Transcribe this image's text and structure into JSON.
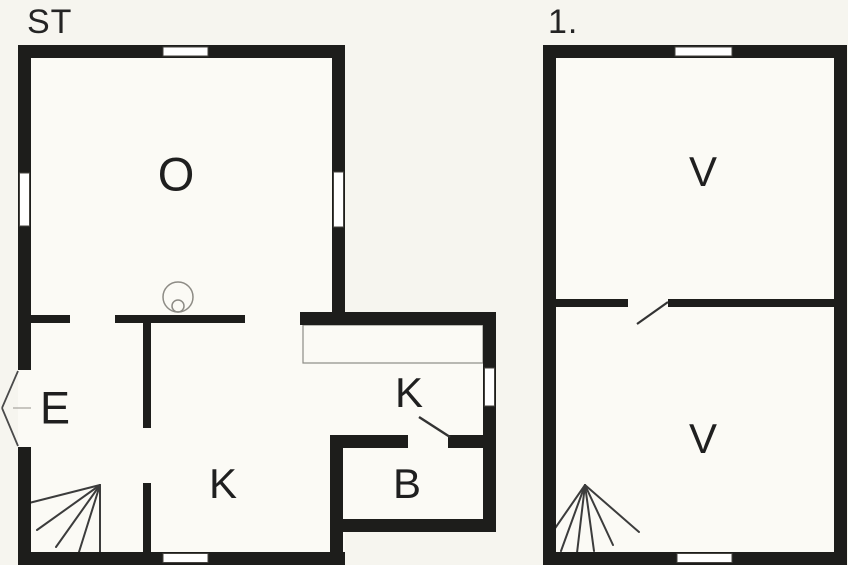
{
  "colors": {
    "wall": "#1d1d1b",
    "background": "#f6f5ef",
    "floor": "#fbfaf5",
    "window": "#ffffff",
    "stair_line": "#3c3c3c",
    "door_line": "#333333",
    "fixture_outline": "#8d8b85"
  },
  "floors": [
    {
      "title": "ST",
      "rooms": [
        {
          "label": "O"
        },
        {
          "label": "E"
        },
        {
          "label": "K"
        },
        {
          "label": "K"
        },
        {
          "label": "B"
        }
      ],
      "symbols": [
        "entrance-door-icon",
        "stove-icon",
        "stairs-icon",
        "door-swing-icon",
        "kitchen-counter",
        "window"
      ]
    },
    {
      "title": "1.",
      "rooms": [
        {
          "label": "V"
        },
        {
          "label": "V"
        }
      ],
      "symbols": [
        "stairs-icon",
        "door-swing-icon",
        "window"
      ]
    }
  ]
}
